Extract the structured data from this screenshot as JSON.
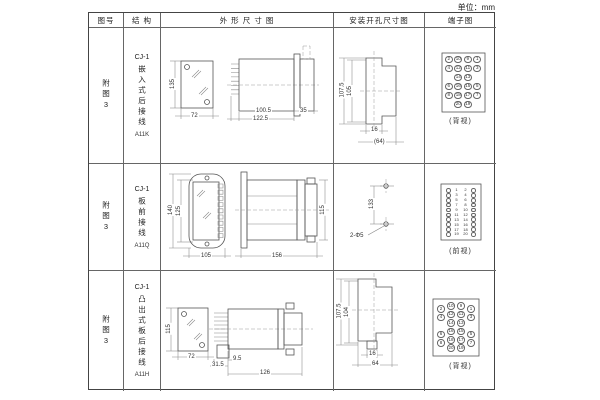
{
  "unit_label": "单位：mm",
  "header": {
    "figure": "图号",
    "structure": "结 构",
    "outline": "外 形 尺 寸 图",
    "install": "安装开孔尺寸图",
    "terminal": "端子图"
  },
  "rows": [
    {
      "figure_no": "附图3",
      "structure": {
        "model": "CJ-1",
        "desc": "嵌入式后接线",
        "code": "A11K"
      },
      "outline": {
        "height": "135",
        "width": "72",
        "depth": "100.5",
        "total_depth": "122.5",
        "flange_depth": "35"
      },
      "install": {
        "outer_height": "107.5",
        "inner_height": "105",
        "slot_width": "16",
        "span": "(64)"
      },
      "terminal": {
        "view_label": "(背视)",
        "grid": {
          "rows": [
            [
              2,
              10,
              9,
              1
            ],
            [
              4,
              12,
              11,
              3
            ],
            [
              null,
              14,
              13,
              null
            ],
            [
              6,
              16,
              15,
              5
            ],
            [
              8,
              18,
              17,
              7
            ],
            [
              null,
              20,
              19,
              null
            ]
          ]
        }
      }
    },
    {
      "figure_no": "附图3",
      "structure": {
        "model": "CJ-1",
        "desc": "板前接线",
        "code": "A11Q"
      },
      "outline": {
        "outer_height": "140",
        "inner_height": "125",
        "width": "105",
        "length": "156",
        "side_height": "115"
      },
      "install": {
        "hole_spacing": "133",
        "holes": "2-Φ5"
      },
      "terminal": {
        "view_label": "(前视)",
        "pairs": {
          "left": [
            1,
            3,
            5,
            7,
            9,
            11,
            13,
            15,
            17,
            19
          ],
          "right": [
            2,
            4,
            6,
            8,
            10,
            12,
            14,
            16,
            18,
            20
          ]
        }
      }
    },
    {
      "figure_no": "附图3",
      "structure": {
        "model": "CJ-1",
        "desc": "凸出式板后接线",
        "code": "A11H"
      },
      "outline": {
        "height": "115",
        "width": "72",
        "pin_length": "31.5",
        "step": "9.5",
        "depth": "126"
      },
      "install": {
        "outer_height": "107.5",
        "inner_height": "104",
        "slot_width": "16",
        "span": "64"
      },
      "terminal": {
        "view_label": "(背视)",
        "grid": {
          "rows": [
            [
              2,
              10,
              9,
              1
            ],
            [
              4,
              12,
              11,
              3
            ],
            [
              null,
              14,
              13,
              null
            ],
            [
              6,
              16,
              15,
              5
            ],
            [
              8,
              18,
              17,
              7
            ],
            [
              null,
              20,
              19,
              null
            ]
          ]
        }
      }
    }
  ]
}
